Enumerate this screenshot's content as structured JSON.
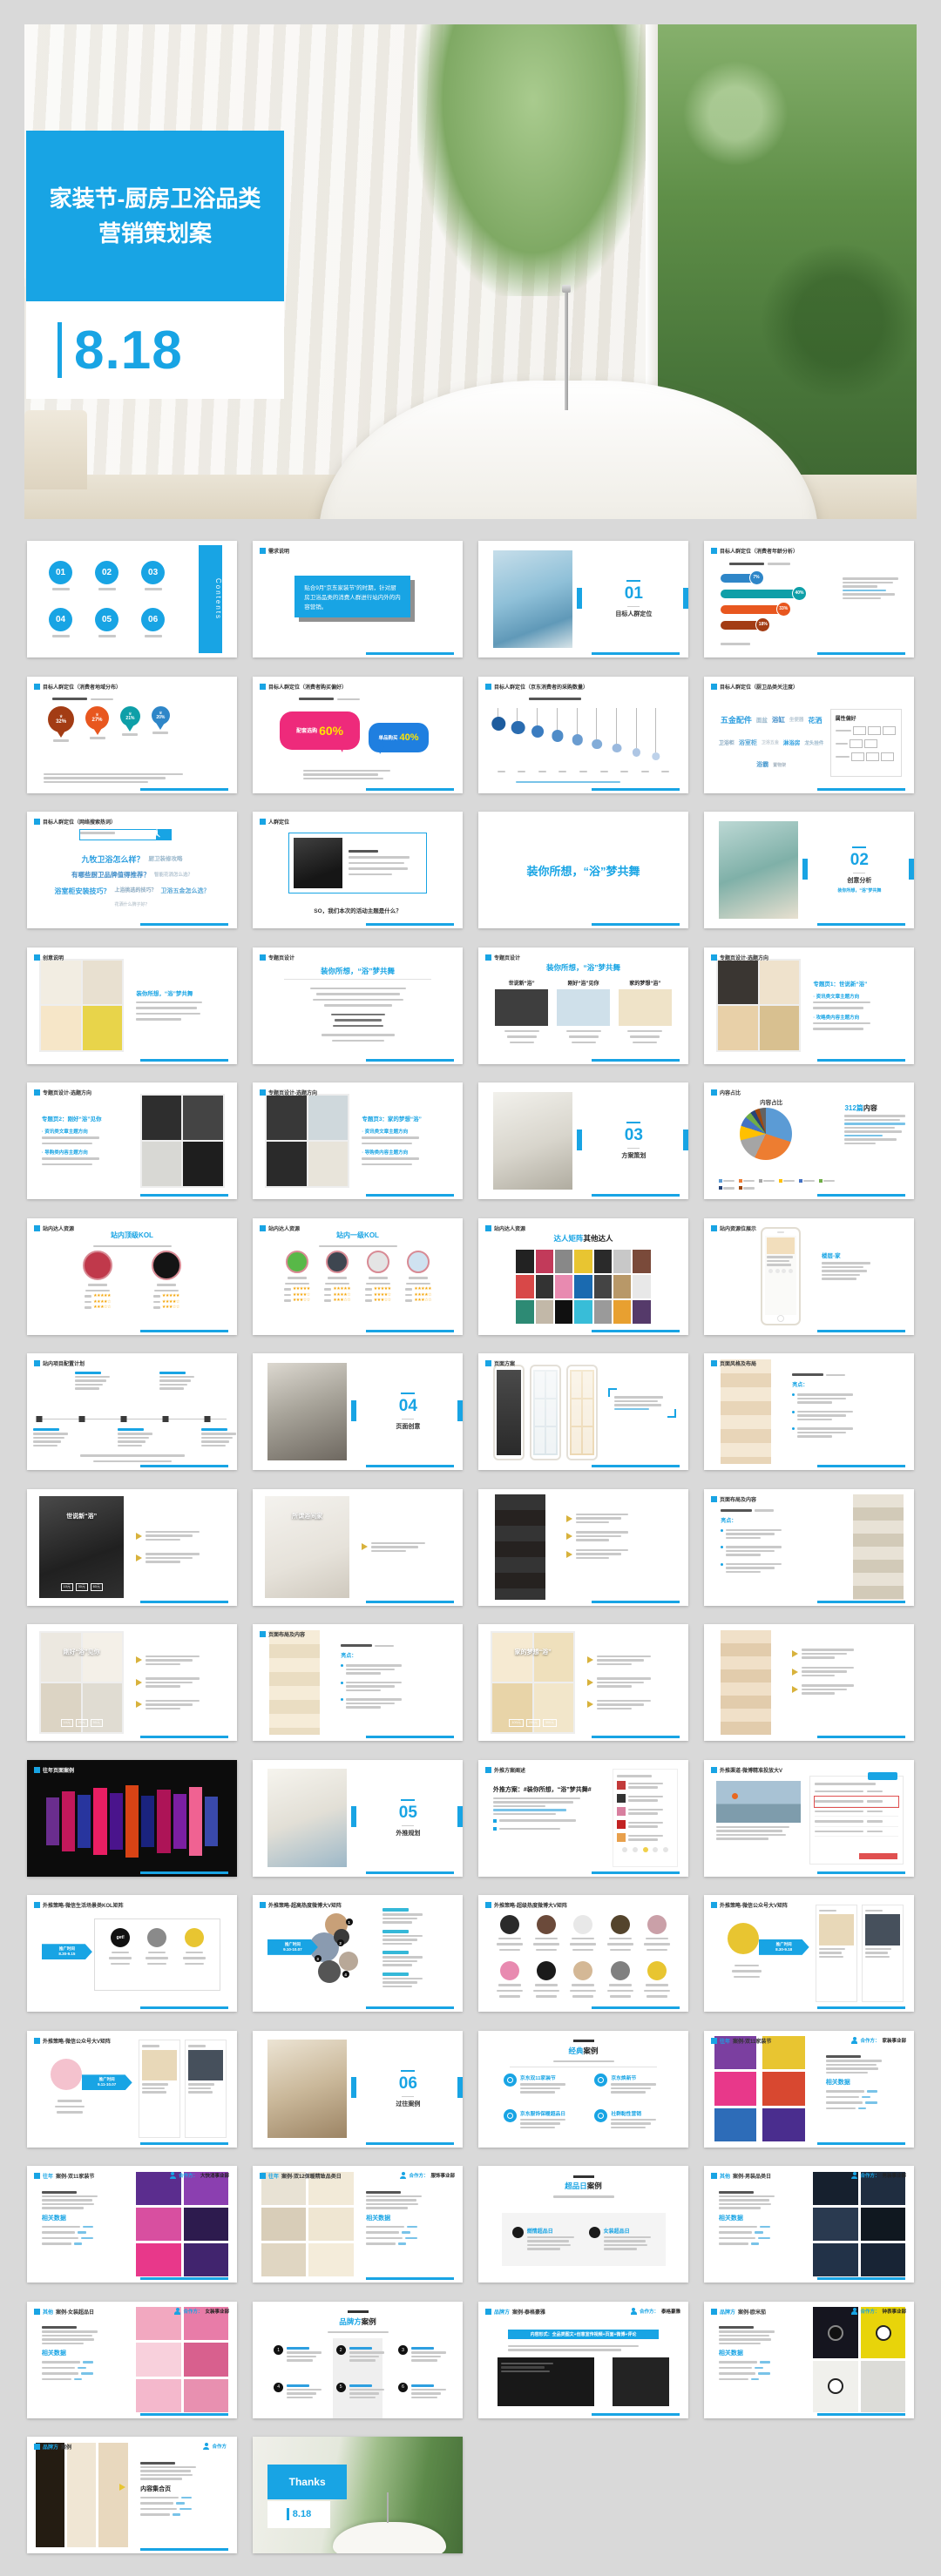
{
  "page": {
    "background": "#d9d9d9",
    "accent": "#18a4e4"
  },
  "hero": {
    "title_line1": "家装节-厨房卫浴品类",
    "title_line2": "营销策划案",
    "date": "8.18"
  },
  "slides": [
    {
      "k": "contents",
      "nums": [
        "01",
        "02",
        "03",
        "04",
        "05",
        "06"
      ],
      "side_label": "Contents"
    },
    {
      "k": "hdrbox",
      "hdr": "需求说明",
      "box": "贴合9月“京东家装节”的时期，针对厨房卫浴品类的消费人群进行站内外的内容营销。"
    },
    {
      "k": "section",
      "num": "01",
      "title": "目标人群定位",
      "img": "bathblue"
    },
    {
      "k": "bubbles",
      "hdr": "目标人群定位（消费者年龄分析）",
      "items": [
        {
          "p": "7%",
          "c": "#2e86c8",
          "w": 34
        },
        {
          "p": "40%",
          "c": "#0e9fa8",
          "w": 72
        },
        {
          "p": "33%",
          "c": "#e8571f",
          "w": 58
        },
        {
          "p": "18%",
          "c": "#a33c14",
          "w": 40
        }
      ]
    },
    {
      "k": "pins",
      "hdr": "目标人群定位（消费者地域分布）",
      "items": [
        {
          "p": "32%",
          "c": "#a33c14"
        },
        {
          "p": "27%",
          "c": "#e8571f"
        },
        {
          "p": "21%",
          "c": "#0e9fa8"
        },
        {
          "p": "20%",
          "c": "#2e86c8"
        }
      ]
    },
    {
      "k": "speech",
      "hdr": "目标人群定位（消费者购买偏好）",
      "a_label": "配套选购",
      "a_pct": "60%",
      "b_label": "单品购买",
      "b_pct": "40%"
    },
    {
      "k": "drops",
      "hdr": "目标人群定位（京东消费者的采购数量）"
    },
    {
      "k": "cloudpanel",
      "hdr": "目标人群定位（厨卫品类关注度）",
      "panel_title": "属性偏好",
      "words": [
        "五金配件",
        "面盆",
        "浴缸",
        "坐便器",
        "花洒",
        "卫浴柜",
        "浴室柜",
        "卫浴五金",
        "淋浴房",
        "龙头挂件",
        "浴霸",
        "置物架"
      ]
    },
    {
      "k": "cloudpanel",
      "search": true,
      "hdr": "目标人群定位（网络搜索热词）",
      "words": [
        "九牧卫浴怎么样？",
        "厨卫装修攻略",
        "有哪些厨卫品牌值得推荐？",
        "智能花洒怎么选？",
        "浴室柜安装技巧？",
        "上浴挑选的技巧？",
        "卫浴五金怎么选？",
        "花洒什么牌子好？"
      ]
    },
    {
      "k": "imgtext",
      "hdr": "人群定位",
      "img": "darktile",
      "boxed": true,
      "bottom": "SO，我们本次的活动主题是什么？"
    },
    {
      "k": "bigtitle",
      "title": "装你所想，“浴”梦共舞"
    },
    {
      "k": "section",
      "num": "02",
      "title": "创意分析",
      "img": "bathteal",
      "sub": "装你所想，“浴”梦共舞"
    },
    {
      "k": "imgtext",
      "hdr": "创意说明",
      "img": "collage_bath",
      "side": "left",
      "title": "装你所想，“浴”梦共舞",
      "para": 4
    },
    {
      "k": "textpage",
      "hdr": "专题页设计",
      "title": "装你所想，“浴”梦共舞"
    },
    {
      "k": "threecol",
      "hdr": "专题页设计",
      "title": "装你所想，“浴”梦共舞",
      "cols": [
        "世说新“浴”",
        "刚好“浴”见你",
        "家的梦想“浴”"
      ]
    },
    {
      "k": "imgtext",
      "hdr": "专题页设计-选题方向",
      "img": "collage_warm",
      "side": "left",
      "title": "专题页1：世说新“浴”",
      "bullets": [
        "资讯类文章主题方向",
        "攻略类内容主题方向"
      ]
    },
    {
      "k": "imgtext",
      "hdr": "专题页设计-选题方向",
      "img": "collage_dark",
      "side": "right",
      "title": "专题页2：刚好“浴”见你",
      "bullets": [
        "资讯类文章主题方向",
        "导购类内容主题方向"
      ]
    },
    {
      "k": "imgtext",
      "hdr": "专题页设计-选题方向",
      "img": "collage_dark2",
      "side": "left",
      "title": "专题页3：家的梦想“浴”",
      "bullets": [
        "资讯类文章主题方向",
        "导购类内容主题方向"
      ]
    },
    {
      "k": "section",
      "num": "03",
      "title": "方案策划",
      "img": "bathwhite"
    },
    {
      "k": "pie",
      "hdr": "内容占比",
      "pie_title": "内容占比",
      "right_blue": "312篇",
      "right_black": "内容"
    },
    {
      "k": "kol",
      "hdr": "站内达人资源",
      "title": "站内顶级KOL",
      "circles": [
        "#c0394b",
        "#141414"
      ]
    },
    {
      "k": "kol",
      "hdr": "站内达人资源",
      "title": "站内一级KOL",
      "circles": [
        "#58b848",
        "#3e4650",
        "#e4e4e4",
        "#cfe2f0"
      ]
    },
    {
      "k": "avatargrid",
      "hdr": "站内达人资源",
      "title_blue": "达人矩阵",
      "title_black": "其他达人"
    },
    {
      "k": "phoneright",
      "hdr": "站内资源位展示",
      "title": "楼层-家"
    },
    {
      "k": "timeline",
      "hdr": "站内项目配置计划"
    },
    {
      "k": "section",
      "num": "04",
      "title": "页面创意",
      "img": "bathstone"
    },
    {
      "k": "phones3",
      "hdr": "页面方案"
    },
    {
      "k": "longpage",
      "hdr": "页面风格及布局",
      "strip": "warm",
      "strip_side": "left",
      "mode": "bullets",
      "bullets_title": "亮点："
    },
    {
      "k": "imgtext",
      "img": "darkbath",
      "side": "left",
      "img_label": "世说新“浴”",
      "chips": [
        "10元",
        "30元",
        "60元"
      ],
      "arrows": 2
    },
    {
      "k": "imgtext",
      "img": "bathlight",
      "side": "left",
      "img_label": "所谓浴间家",
      "arrows": 1
    },
    {
      "k": "longpage",
      "strip": "darkmix",
      "strip_side": "left",
      "mode": "arrows"
    },
    {
      "k": "longpage",
      "hdr": "页面布局及内容",
      "strip": "collage",
      "strip_side": "right",
      "mode": "bullets",
      "bullets_title": "亮点："
    },
    {
      "k": "imgtext",
      "img": "collage_soft",
      "side": "left",
      "img_label": "刚好“浴”见你",
      "chips": [
        "10元",
        "20元",
        "50元"
      ],
      "arrows": 3
    },
    {
      "k": "longpage",
      "hdr": "页面布局及内容",
      "strip": "cream",
      "strip_side": "left",
      "mode": "bullets",
      "bullets_title": "亮点："
    },
    {
      "k": "imgtext",
      "img": "cream_poster",
      "side": "left",
      "img_label": "家的梦想“浴”",
      "chips": [
        "100元",
        "200元",
        "300元"
      ],
      "arrows": 3
    },
    {
      "k": "longpage",
      "strip": "warm2",
      "strip_side": "left",
      "mode": "arrows"
    },
    {
      "k": "darkcollage",
      "hdr": "往年页面案例"
    },
    {
      "k": "section",
      "num": "05",
      "title": "外推规划",
      "img": "bathwin"
    },
    {
      "k": "feedtext",
      "hdr": "外推方案阐述",
      "title": "外推方案：#装你所想，“浴”梦共舞#"
    },
    {
      "k": "weibo2",
      "hdr": "外推渠道-微博精准投放大V"
    },
    {
      "k": "logobox",
      "hdr": "外推策略-微信生活场景类KOL矩阵",
      "tag_label": "推广时间",
      "tag_date": "8.30-9.15",
      "logo_text": "get!"
    },
    {
      "k": "kolcluster",
      "hdr": "外推策略-超高热度微博大V矩阵",
      "tag_label": "推广时间",
      "tag_date": "9.10-10.07"
    },
    {
      "k": "avatarrows",
      "hdr": "外推策略-超级热度微博大V矩阵"
    },
    {
      "k": "pubaccount",
      "hdr": "外推策略-微信公众号大V矩阵",
      "tag_label": "推广时间",
      "tag_date": "8.30-9.18",
      "logo": "#e8c531"
    },
    {
      "k": "pubaccount",
      "hdr": "外推策略-微信公众号大V矩阵",
      "tag_label": "推广时间",
      "tag_date": "9.11-10.07",
      "logo": "#f4c2ce"
    },
    {
      "k": "section",
      "num": "06",
      "title": "过往案例",
      "img": "bathwood"
    },
    {
      "k": "brandlist",
      "title_blue": "经典",
      "title_black": "案例",
      "items": [
        "京东双11家装节",
        "京东焕新节",
        "京东服饰保暖超品日",
        "社群黏性营销"
      ]
    },
    {
      "k": "case",
      "hdr": "往年案例-双11家装节",
      "coop": "合作方：家装事业部",
      "data_title": "相关数据",
      "layout": "double",
      "palette": "mixed"
    },
    {
      "k": "case",
      "hdr": "往年案例-双11家装节",
      "coop": "合作方：大快消事业部",
      "data_title": "相关数据",
      "layout": "collage-right",
      "palette": "purple"
    },
    {
      "k": "case",
      "hdr": "往年案例-双12保暖精致品类日",
      "coop": "合作方：服饰事业部",
      "data_title": "相关数据",
      "layout": "collage-left",
      "palette": "paper"
    },
    {
      "k": "duocase",
      "title_blue": "超品日",
      "title_black": "案例",
      "items": [
        "燃情超品日",
        "女装超品日"
      ]
    },
    {
      "k": "case",
      "hdr": "其他案例-男装品类日",
      "coop": "合作方：男装事业部",
      "data_title": "相关数据",
      "layout": "collage-right",
      "palette": "navy"
    },
    {
      "k": "case",
      "hdr": "其他案例-女装超品日",
      "coop": "合作方：女装事业部",
      "data_title": "相关数据",
      "layout": "collage-right",
      "palette": "pink"
    },
    {
      "k": "brandtimeline",
      "title_blue": "品牌方",
      "title_black": "案例",
      "nums": [
        "1",
        "2",
        "3",
        "4",
        "5",
        "6"
      ]
    },
    {
      "k": "case",
      "hdr": "品牌方案例-泰格豪雅",
      "coop": "合作方：泰格豪雅",
      "banner": "内容形式：全品类图文+创意宣传视频+页面+微博+评论",
      "layout": "banner",
      "palette": "darkshots"
    },
    {
      "k": "case",
      "hdr": "品牌方案例-欧米茄",
      "coop": "合作方：钟表事业部",
      "data_title": "相关数据",
      "layout": "collage-right",
      "palette": "watch"
    },
    {
      "k": "case",
      "hdr": "品牌方案例",
      "coop": "合作方",
      "data_title": "内容集合页",
      "layout": "collage-left",
      "palette": "warmcase",
      "dt_dark": true
    },
    {
      "k": "thanks",
      "thanks_label": "Thanks",
      "date": "8.18"
    }
  ]
}
